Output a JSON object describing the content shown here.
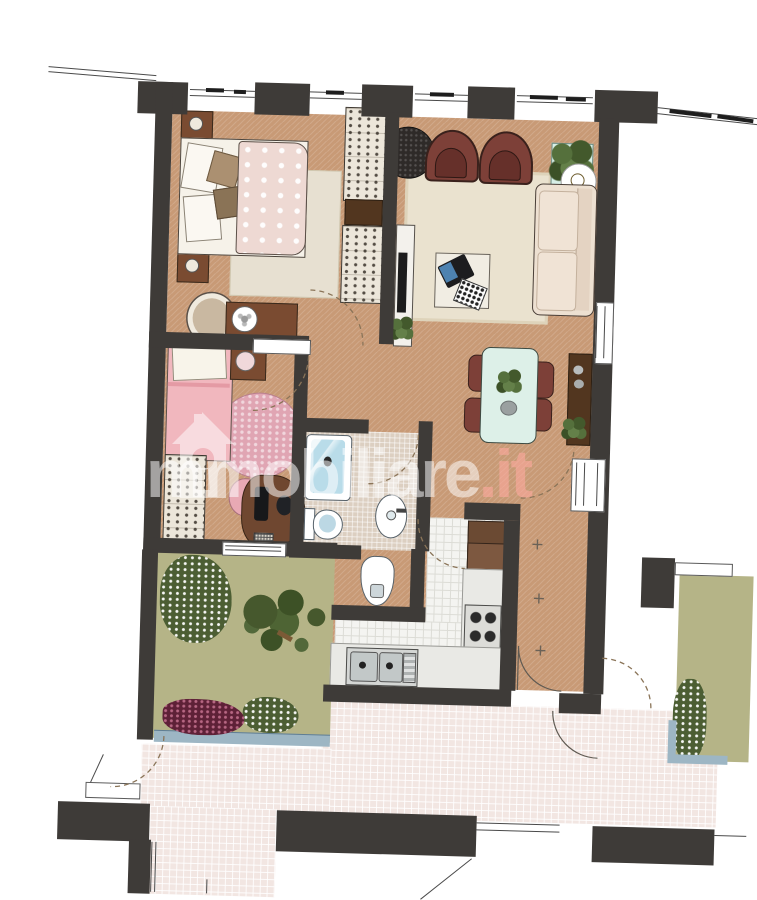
{
  "watermark": {
    "brand": "immobiliare",
    "tld": ".it",
    "logo": "house-keyhole-icon"
  },
  "palette": {
    "wall": "#3e3b38",
    "tan": "#c89a76",
    "rug": "#e9e1cf",
    "sofa": "#ede0d1",
    "maroon": "#7d4038",
    "maroon_dark": "#66302a",
    "mint": "#d8f0e8",
    "plant_green": "#55703c",
    "olive": "#b5b487",
    "burgundy": "#5e2137",
    "water_blue": "#b9dce9",
    "bathtile": "#dccfc1",
    "ktile": "#f4f4f1",
    "counter": "#e9e9e5",
    "terrace": "#f2e6e2",
    "pinkbed": "#f1b7be",
    "pinkrug": "#e0a5b3",
    "wood": "#7a4b31",
    "darkwood": "#52361f",
    "wmcolor": "rgba(255,255,255,0.53)"
  },
  "floorplan": {
    "rooms": [
      "bedroom-1",
      "bedroom-2",
      "living-room",
      "dining-area",
      "bathroom",
      "wc-nook",
      "kitchen",
      "hallway",
      "garden-left",
      "garden-right",
      "terrace"
    ],
    "furniture": {
      "bedroom_1": [
        "double-bed",
        "nightstand",
        "nightstand",
        "rug",
        "desk",
        "chair",
        "wardrobe",
        "wardrobe"
      ],
      "bedroom_2": [
        "single-bed",
        "round-rug",
        "wardrobe",
        "desk",
        "chair",
        "vanity"
      ],
      "living_room": [
        "armchair",
        "armchair",
        "sofa",
        "rug",
        "coffee-table",
        "laptop",
        "tv-console",
        "plant",
        "round-side-table",
        "ceiling-light"
      ],
      "dining_area": [
        "dining-table",
        "chair",
        "chair",
        "chair",
        "chair",
        "sideboard",
        "plant"
      ],
      "bathroom": [
        "bathtub",
        "toilet",
        "sink",
        "bidet"
      ],
      "kitchen": [
        "sink-unit",
        "stove",
        "counter",
        "cabinet"
      ],
      "garden": [
        "tree",
        "flower-bed",
        "bushes"
      ]
    }
  }
}
